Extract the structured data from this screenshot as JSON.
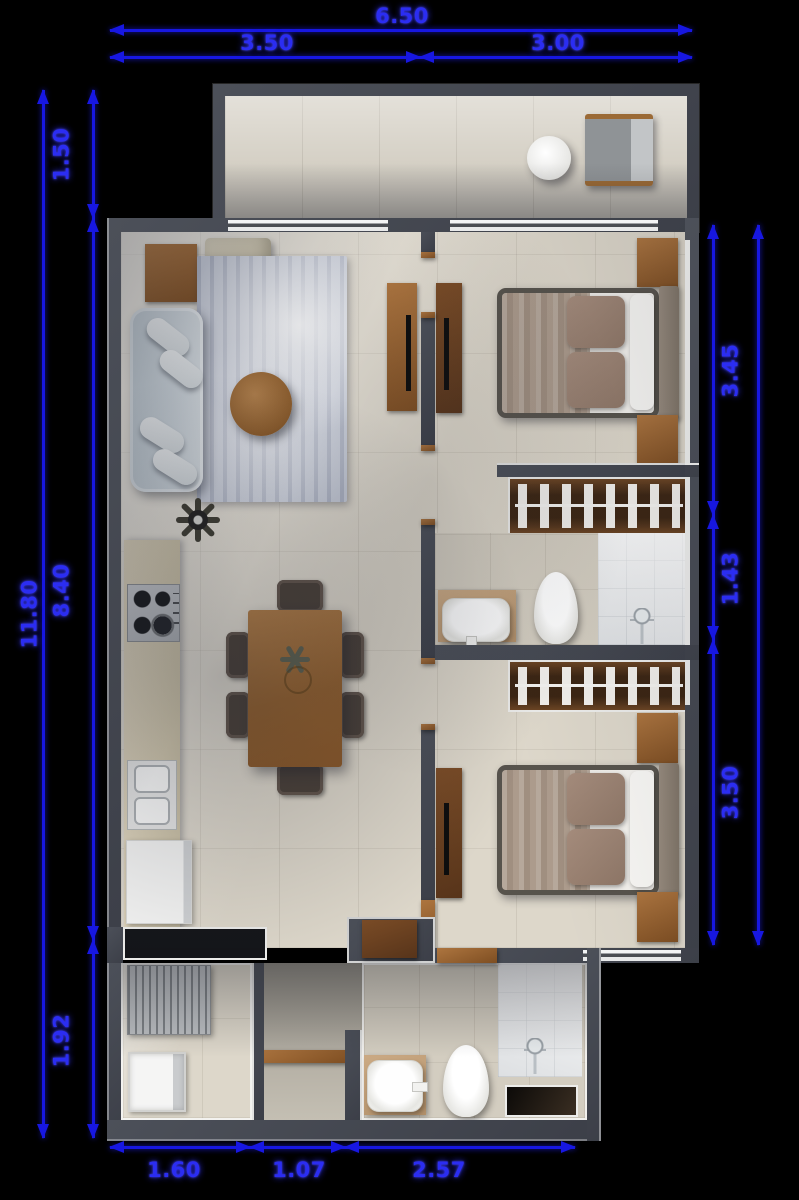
{
  "dimensions": {
    "top": {
      "total": "6.50",
      "segments": [
        "3.50",
        "3.00"
      ]
    },
    "left": {
      "total": "11.80",
      "segments": [
        "1.50",
        "8.40",
        "1.92"
      ]
    },
    "right": {
      "segments": [
        "3.45",
        "1.43",
        "3.50"
      ]
    },
    "bottom": {
      "segments": [
        "1.60",
        "1.07",
        "2.57"
      ]
    }
  },
  "colors": {
    "background": "#000000",
    "dimension_blue": "#1717e2",
    "label_blue": "#2b2df2",
    "wall_gray": "#464a54",
    "floor_beige": "#dcd6c9",
    "wood_brown": "#9c6b36",
    "rug_gray_blue": "#c7ccd8"
  }
}
